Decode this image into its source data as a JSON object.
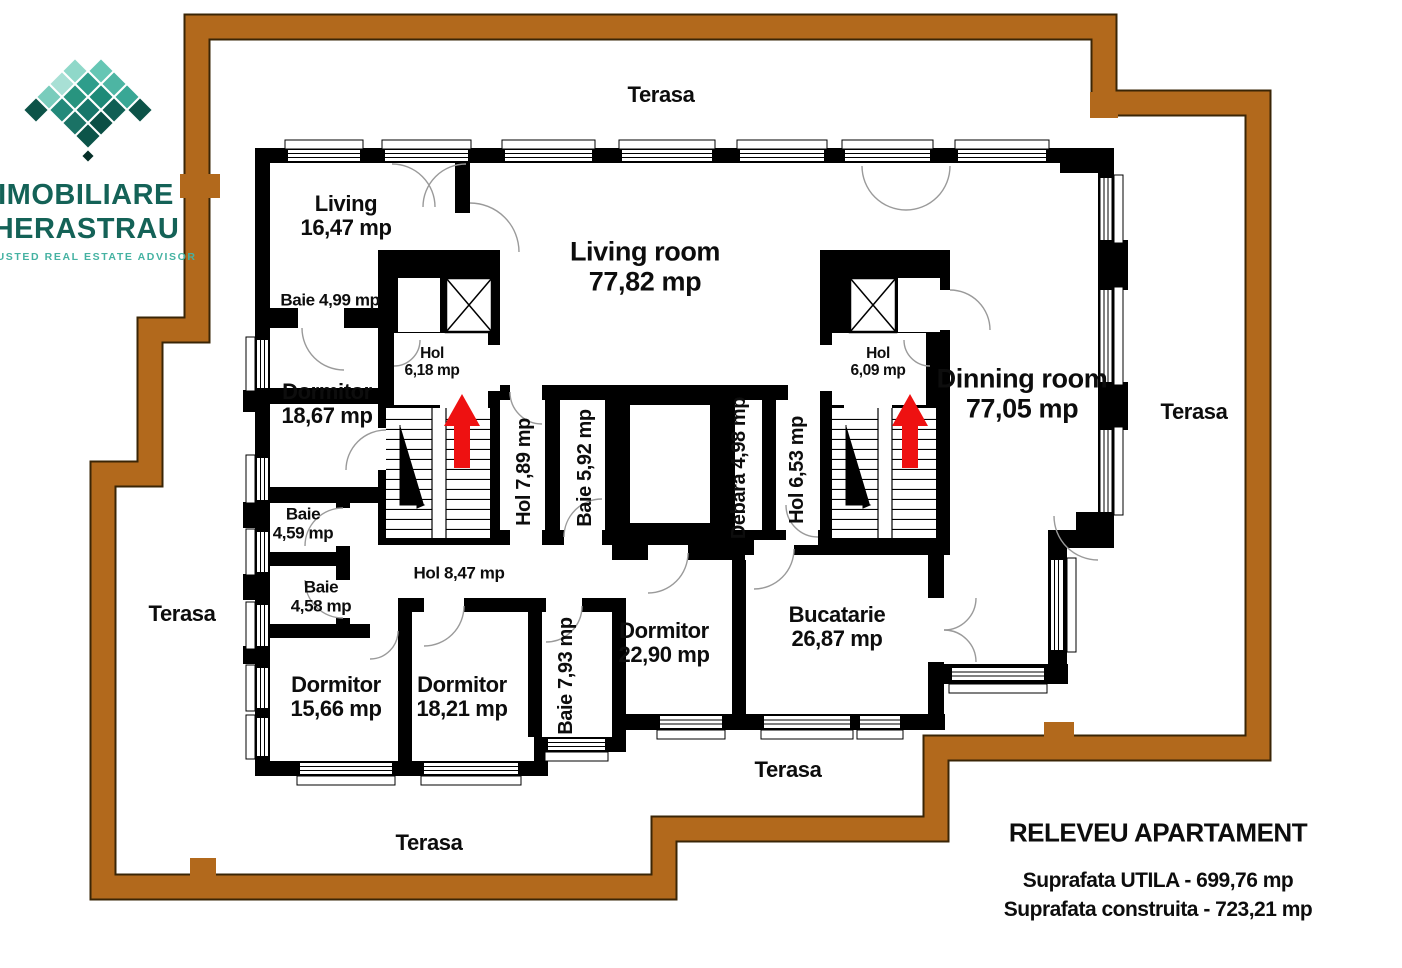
{
  "logo": {
    "line1": "IMOBILIARE",
    "line2": "HERASTRAU",
    "tagline": "TRUSTED REAL ESTATE ADVISOR"
  },
  "plan": {
    "terrace_labels": {
      "top": "Terasa",
      "right": "Terasa",
      "left": "Terasa",
      "bottom_inner": "Terasa",
      "bottom_outer": "Terasa"
    },
    "rooms": {
      "living_small": {
        "name": "Living",
        "area": "16,47 mp"
      },
      "baie_499": {
        "label": "Baie 4,99 mp"
      },
      "dormitor_1867": {
        "name": "Dormitor",
        "area": "18,67 mp"
      },
      "hol_618": {
        "name": "Hol",
        "area": "6,18 mp"
      },
      "living_room": {
        "name": "Living room",
        "area": "77,82 mp"
      },
      "hol_609": {
        "name": "Hol",
        "area": "6,09 mp"
      },
      "dinning_room": {
        "name": "Dinning room",
        "area": "77,05 mp"
      },
      "hol_789": {
        "label": "Hol 7,89 mp"
      },
      "baie_592": {
        "label": "Baie 5,92 mp"
      },
      "debara_498": {
        "label": "Debara 4,98 mp"
      },
      "hol_653": {
        "label": "Hol 6,53 mp"
      },
      "baie_459": {
        "name": "Baie",
        "area": "4,59 mp"
      },
      "baie_458": {
        "name": "Baie",
        "area": "4,58 mp"
      },
      "hol_847": {
        "label": "Hol 8,47 mp"
      },
      "dormitor_1566": {
        "name": "Dormitor",
        "area": "15,66 mp"
      },
      "dormitor_1821": {
        "name": "Dormitor",
        "area": "18,21 mp"
      },
      "baie_793": {
        "label": "Baie 7,93 mp"
      },
      "dormitor_2290": {
        "name": "Dormitor",
        "area": "22,90 mp"
      },
      "bucatarie": {
        "name": "Bucatarie",
        "area": "26,87 mp"
      }
    }
  },
  "title_block": {
    "title": "RELEVEU APARTAMENT",
    "usable_area": "Suprafata UTILA - 699,76 mp",
    "built_area": "Suprafata construita - 723,21 mp"
  },
  "colors": {
    "terrace_outline": "#b2691c",
    "wall": "#000000",
    "arrow": "#ee1111",
    "logo_teal_dark": "#146257",
    "logo_teal_light": "#45b2a2"
  }
}
